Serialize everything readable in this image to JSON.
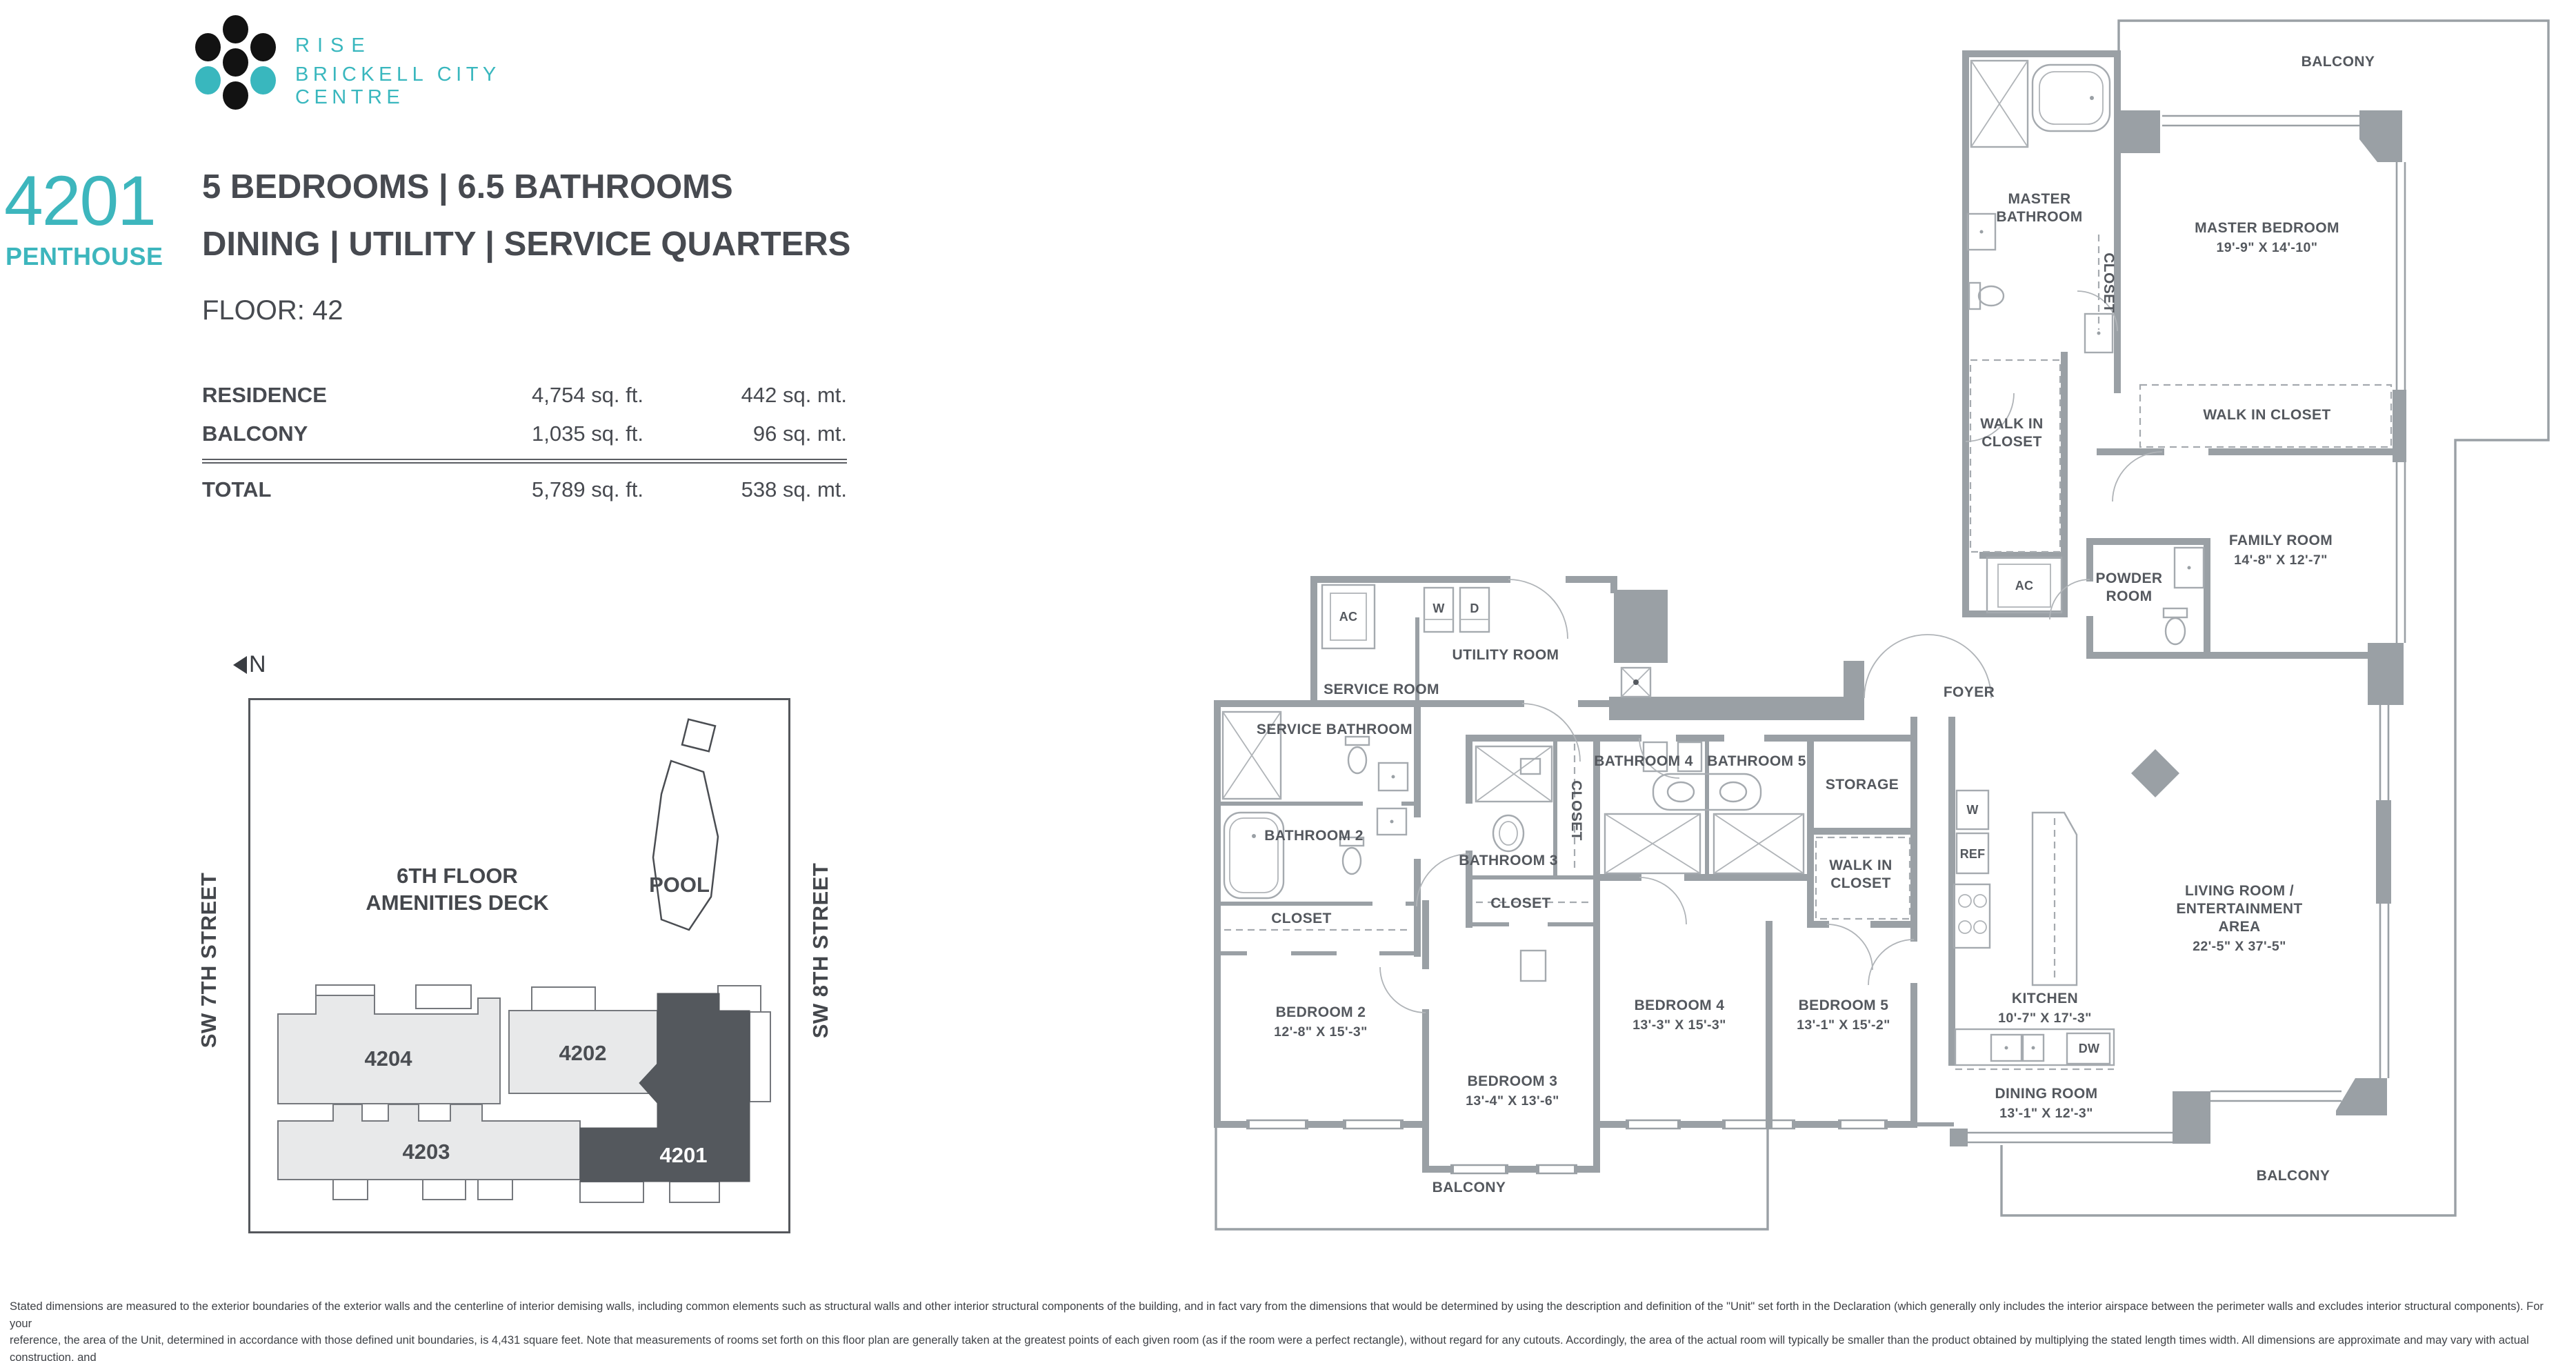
{
  "header": {
    "logo_line1": "RISE",
    "logo_line2": "BRICKELL CITY CENTRE",
    "unit_number": "4201",
    "unit_type": "PENTHOUSE",
    "spec_line1": "5 BEDROOMS  |  6.5 BATHROOMS",
    "spec_line2": "DINING  |  UTILITY  |  SERVICE QUARTERS",
    "floor": "FLOOR: 42"
  },
  "area_table": {
    "rows": [
      {
        "label": "RESIDENCE",
        "sqft": "4,754 sq. ft.",
        "sqmt": "442 sq. mt."
      },
      {
        "label": "BALCONY",
        "sqft": "1,035 sq. ft.",
        "sqmt": "96 sq. mt."
      }
    ],
    "total": {
      "label": "TOTAL",
      "sqft": "5,789 sq. ft.",
      "sqmt": "538 sq. mt."
    }
  },
  "site_plan": {
    "north_label": "N",
    "street_left": "SW 7TH STREET",
    "street_right": "SW 8TH STREET",
    "deck_line1": "6TH  FLOOR",
    "deck_line2": "AMENITIES DECK",
    "pool": "POOL",
    "units": {
      "u4204": "4204",
      "u4202": "4202",
      "u4203": "4203",
      "u4201": "4201"
    }
  },
  "plan": {
    "rooms": {
      "balcony_top": {
        "name": "BALCONY"
      },
      "master_bathroom": {
        "name": "MASTER BATHROOM"
      },
      "master_closet": {
        "name": "CLOSET"
      },
      "master_bedroom": {
        "name": "MASTER BEDROOM",
        "dims": "19'-9\" X 14'-10\""
      },
      "walk_in_closet_master_right": {
        "name": "WALK IN CLOSET"
      },
      "walk_in_closet_master_left": {
        "name": "WALK IN CLOSET"
      },
      "family_room": {
        "name": "FAMILY ROOM",
        "dims": "14'-8\" X 12'-7\""
      },
      "powder_room": {
        "name": "POWDER ROOM"
      },
      "foyer": {
        "name": "FOYER"
      },
      "service_room": {
        "name": "SERVICE ROOM"
      },
      "utility_room": {
        "name": "UTILITY ROOM"
      },
      "service_bathroom": {
        "name": "SERVICE BATHROOM"
      },
      "bathroom_2": {
        "name": "BATHROOM 2"
      },
      "closet_bathroom_2": {
        "name": "CLOSET"
      },
      "bathroom_3": {
        "name": "BATHROOM 3"
      },
      "closet_bathroom_3_side": {
        "name": "CLOSET"
      },
      "closet_bedroom_3": {
        "name": "CLOSET"
      },
      "bathroom_4": {
        "name": "BATHROOM 4"
      },
      "bathroom_5": {
        "name": "BATHROOM 5"
      },
      "storage": {
        "name": "STORAGE"
      },
      "walk_in_closet_bedroom_5": {
        "name": "WALK IN CLOSET"
      },
      "kitchen": {
        "name": "KITCHEN",
        "dims": "10'-7\" X 17'-3\""
      },
      "living_room": {
        "name": "LIVING ROOM / ENTERTAINMENT AREA",
        "dims": "22'-5\" X 37'-5\""
      },
      "dining_room": {
        "name": "DINING ROOM",
        "dims": "13'-1\" X 12'-3\""
      },
      "bedroom_2": {
        "name": "BEDROOM 2",
        "dims": "12'-8\" X 15'-3\""
      },
      "bedroom_3": {
        "name": "BEDROOM 3",
        "dims": "13'-4\" X 13'-6\""
      },
      "bedroom_4": {
        "name": "BEDROOM 4",
        "dims": "13'-3\" X 15'-3\""
      },
      "bedroom_5": {
        "name": "BEDROOM 5",
        "dims": "13'-1\" X 15'-2\""
      },
      "balcony_bottom": {
        "name": "BALCONY"
      },
      "balcony_right": {
        "name": "BALCONY"
      }
    },
    "appliances": {
      "ac_service": "AC",
      "ac_hall": "AC",
      "washer_utility": "W",
      "dryer_utility": "D",
      "washer_kitchen": "W",
      "refrigerator": "REF",
      "dishwasher": "DW"
    }
  },
  "footer": {
    "line1": "Stated dimensions are measured to the exterior boundaries of the exterior walls and the centerline of interior demising walls, including common elements such as structural walls and other interior structural components of the building, and in fact vary from the dimensions that would be determined by using the description and definition of the \"Unit\" set forth in the Declaration (which generally only includes the interior airspace between the perimeter walls and excludes interior structural components). For your",
    "line2": "reference, the area of the Unit, determined in accordance with those defined unit boundaries, is 4,431 square feet. Note that measurements of rooms set forth on this floor plan are generally taken at the greatest points of each given room (as if the room were a perfect rectangle), without regard for any cutouts. Accordingly, the area of the actual room will typically be smaller than the product obtained by multiplying the stated length times width. All dimensions are approximate and may vary with actual construction, and",
    "line3": "all floor plans and development plans are subject to change. The size and configuration of balconies and terraces varies throughout the building. The balcony depicted above is among the larger balconies and is not reflective of the actual size or configuration of the balcony for each unit of this unit type. For the actual size and configuration of the balcony for your unit, see Exhibit \"2\" to the Declaration of Condominium. See legal disclaimer on back cover."
  },
  "colors": {
    "accent_teal": "#39b7be",
    "text_dark": "#474a50",
    "wall_gray": "#9aa0a5",
    "unit_highlight": "#54585d",
    "unit_light": "#e8e9ea"
  }
}
